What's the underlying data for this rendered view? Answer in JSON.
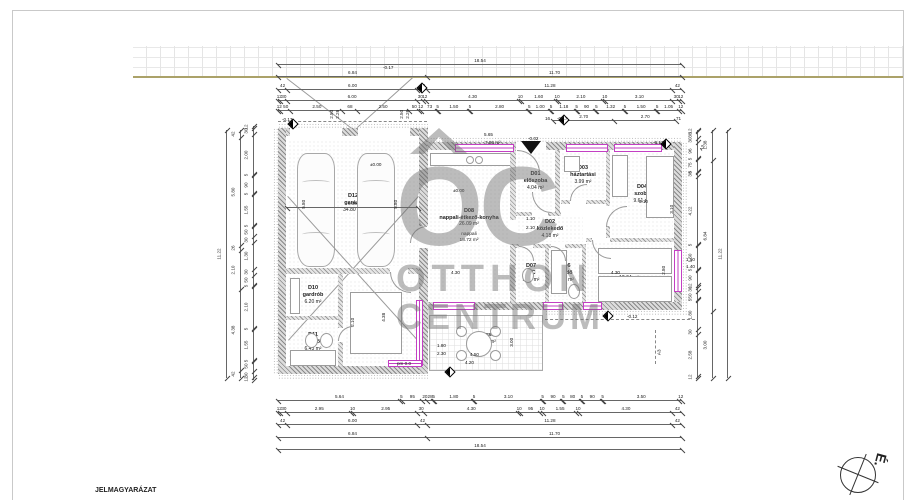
{
  "sheet": {
    "legend_title": "JELMAGYARÁZAT",
    "north_label": "É.",
    "watermark": {
      "oc": "OC",
      "line2": "OTTHON",
      "line3": "CENTRUM"
    },
    "accent_color": "#c33fc3"
  },
  "rooms": [
    {
      "id": "D12",
      "name": "garázs",
      "area": "34.80 m²",
      "x": 288,
      "y": 140,
      "w": 130,
      "h": 126
    },
    {
      "id": "D10",
      "name": "gardrób",
      "area": "6.20 m²",
      "x": 288,
      "y": 276,
      "w": 50,
      "h": 38
    },
    {
      "id": "D11",
      "name": "fürdő",
      "area": "6.43 m²",
      "x": 288,
      "y": 322,
      "w": 50,
      "h": 40
    },
    {
      "id": "D09",
      "name": "szoba",
      "area": "12.92 m²",
      "x": 345,
      "y": 280,
      "w": 74,
      "h": 84
    },
    {
      "id": "D08",
      "name": "nappali-étkező-konyha",
      "area": "26.09 m²",
      "sub1": "nappali",
      "sub2": "18.72 m²",
      "x": 429,
      "y": 152,
      "w": 80,
      "h": 148
    },
    {
      "id": "D01",
      "name": "előszoba",
      "area": "4.04 m²",
      "x": 517,
      "y": 152,
      "w": 37,
      "h": 58
    },
    {
      "id": "D02",
      "name": "közlekedő",
      "area": "4.18 m²",
      "x": 517,
      "y": 216,
      "w": 66,
      "h": 26
    },
    {
      "id": "D03",
      "name": "háztartási",
      "area": "3.99 m²",
      "x": 561,
      "y": 152,
      "w": 44,
      "h": 46
    },
    {
      "id": "D04",
      "name": "szoba",
      "area": "9.61 m²",
      "x": 611,
      "y": 152,
      "w": 62,
      "h": 84
    },
    {
      "id": "D07",
      "name": "WC",
      "area": "1.61 m²",
      "x": 517,
      "y": 246,
      "w": 28,
      "h": 54
    },
    {
      "id": "D06",
      "name": "fürdő",
      "area": "5.39 m²",
      "x": 549,
      "y": 246,
      "w": 33,
      "h": 54
    },
    {
      "id": "D05",
      "name": "szoba",
      "area": "12.04 m²",
      "x": 586,
      "y": 242,
      "w": 86,
      "h": 58
    },
    {
      "id": "",
      "name": "terasz",
      "area": "13.50 m²",
      "x": 429,
      "y": 315,
      "w": 114,
      "h": 56
    }
  ],
  "dims": [
    {
      "t": "h",
      "x1": 278,
      "x2": 682,
      "y": 64,
      "cells": [
        [
          1854,
          "18.54"
        ]
      ]
    },
    {
      "t": "h",
      "x1": 278,
      "x2": 682,
      "y": 76,
      "cells": [
        [
          684,
          "6.84"
        ],
        [
          1170,
          "11.70"
        ]
      ]
    },
    {
      "t": "h",
      "x1": 278,
      "x2": 682,
      "y": 89,
      "cells": [
        [
          42,
          "42"
        ],
        [
          600,
          "6.00"
        ],
        [
          42,
          "42"
        ],
        [
          1128,
          "11.28"
        ],
        [
          42,
          "42"
        ]
      ]
    },
    {
      "t": "h",
      "x1": 278,
      "x2": 682,
      "y": 100,
      "cells": [
        [
          12,
          "12"
        ],
        [
          30,
          "30"
        ],
        [
          600,
          "6.00"
        ],
        [
          30,
          "30"
        ],
        [
          12,
          "12"
        ],
        [
          430,
          "4.30"
        ],
        [
          10,
          "10"
        ],
        [
          160,
          "1.60"
        ],
        [
          10,
          "10"
        ],
        [
          210,
          "2.10"
        ],
        [
          10,
          "10"
        ],
        [
          310,
          "3.10"
        ],
        [
          30,
          "30"
        ],
        [
          12,
          "12"
        ]
      ]
    },
    {
      "t": "h",
      "x1": 278,
      "x2": 682,
      "y": 110,
      "cells": [
        [
          12,
          "12"
        ],
        [
          50,
          "50"
        ],
        [
          250,
          "2.50"
        ],
        [
          68,
          "68"
        ],
        [
          250,
          "2.50"
        ],
        [
          50,
          "50"
        ],
        [
          12,
          "12"
        ],
        [
          73,
          "73"
        ],
        [
          5,
          "5"
        ],
        [
          150,
          "1.50"
        ],
        [
          5,
          "5"
        ],
        [
          280,
          "2.80"
        ],
        [
          5,
          "5"
        ],
        [
          100,
          "1.00"
        ],
        [
          5,
          "5"
        ],
        [
          118,
          "1.18"
        ],
        [
          5,
          "5"
        ],
        [
          90,
          "90"
        ],
        [
          5,
          "5"
        ],
        [
          132,
          "1.32"
        ],
        [
          5,
          "5"
        ],
        [
          150,
          "1.50"
        ],
        [
          5,
          "5"
        ],
        [
          105,
          "1.05"
        ],
        [
          12,
          "12"
        ]
      ]
    },
    {
      "t": "h",
      "x1": 553,
      "x2": 676,
      "y": 120,
      "cells": [
        [
          270,
          "2.70"
        ],
        [
          270,
          "2.70"
        ]
      ]
    },
    {
      "t": "h",
      "x1": 287,
      "x2": 418,
      "y": 207,
      "cells": [
        [
          600,
          "6.00"
        ]
      ]
    },
    {
      "t": "h",
      "x1": 278,
      "x2": 682,
      "y": 400,
      "cells": [
        [
          564,
          "5.64"
        ],
        [
          5,
          "5"
        ],
        [
          95,
          "95"
        ],
        [
          20,
          "20"
        ],
        [
          28,
          "28"
        ],
        [
          5,
          "5"
        ],
        [
          180,
          "1.80"
        ],
        [
          5,
          "5"
        ],
        [
          310,
          "3.10"
        ],
        [
          5,
          "5"
        ],
        [
          90,
          "90"
        ],
        [
          5,
          "5"
        ],
        [
          80,
          "80"
        ],
        [
          5,
          "5"
        ],
        [
          90,
          "90"
        ],
        [
          5,
          "5"
        ],
        [
          350,
          "3.50"
        ],
        [
          12,
          "12"
        ]
      ]
    },
    {
      "t": "h",
      "x1": 278,
      "x2": 682,
      "y": 412,
      "cells": [
        [
          12,
          "12"
        ],
        [
          30,
          "30"
        ],
        [
          295,
          "2.95"
        ],
        [
          10,
          "10"
        ],
        [
          295,
          "2.95"
        ],
        [
          30,
          "30"
        ],
        [
          430,
          "4.30"
        ],
        [
          10,
          "10"
        ],
        [
          95,
          "95"
        ],
        [
          10,
          "10"
        ],
        [
          155,
          "1.55"
        ],
        [
          10,
          "10"
        ],
        [
          430,
          "4.30"
        ],
        [
          42,
          "42"
        ]
      ]
    },
    {
      "t": "h",
      "x1": 278,
      "x2": 682,
      "y": 424,
      "cells": [
        [
          42,
          "42"
        ],
        [
          600,
          "6.00"
        ],
        [
          42,
          "42"
        ],
        [
          1128,
          "11.28"
        ],
        [
          42,
          "42"
        ]
      ]
    },
    {
      "t": "h",
      "x1": 278,
      "x2": 682,
      "y": 437,
      "cells": [
        [
          684,
          "6.84"
        ],
        [
          1170,
          "11.70"
        ]
      ]
    },
    {
      "t": "h",
      "x1": 278,
      "x2": 682,
      "y": 449,
      "cells": [
        [
          1854,
          "18.54"
        ]
      ]
    },
    {
      "t": "v",
      "x": 226,
      "y1": 130,
      "y2": 378,
      "cells": [
        [
          1122,
          "11.22"
        ]
      ]
    },
    {
      "t": "v",
      "x": 240,
      "y1": 130,
      "y2": 378,
      "cells": [
        [
          42,
          "42"
        ],
        [
          580,
          "5.80"
        ],
        [
          26,
          "26"
        ],
        [
          210,
          "2.10"
        ],
        [
          438,
          "4.38"
        ],
        [
          42,
          "42"
        ]
      ]
    },
    {
      "t": "v",
      "x": 253,
      "y1": 126,
      "y2": 380,
      "cells": [
        [
          12,
          "12"
        ],
        [
          30,
          "30"
        ],
        [
          200,
          "2.00"
        ],
        [
          5,
          "5"
        ],
        [
          90,
          "90"
        ],
        [
          5,
          "5"
        ],
        [
          155,
          "1.55"
        ],
        [
          5,
          "5"
        ],
        [
          50,
          "50"
        ],
        [
          30,
          "30"
        ],
        [
          130,
          "1.30"
        ],
        [
          30,
          "30"
        ],
        [
          50,
          "50"
        ],
        [
          5,
          "5"
        ],
        [
          210,
          "2.10"
        ],
        [
          5,
          "5"
        ],
        [
          155,
          "1.55"
        ],
        [
          5,
          "5"
        ],
        [
          50,
          "50"
        ],
        [
          30,
          "30"
        ],
        [
          12,
          "12"
        ]
      ]
    },
    {
      "t": "v",
      "x": 697,
      "y1": 130,
      "y2": 378,
      "cells": [
        [
          12,
          "12"
        ],
        [
          38,
          "38"
        ],
        [
          30,
          "30"
        ],
        [
          96,
          "96"
        ],
        [
          5,
          "5"
        ],
        [
          75,
          "75"
        ],
        [
          5,
          "5"
        ],
        [
          30,
          "30"
        ],
        [
          422,
          "4.22"
        ],
        [
          5,
          "5"
        ],
        [
          150,
          "1.50"
        ],
        [
          5,
          "5"
        ],
        [
          90,
          "90"
        ],
        [
          12,
          "12"
        ],
        [
          30,
          "30"
        ],
        [
          50,
          "50"
        ],
        [
          5,
          "5"
        ],
        [
          180,
          "1.80"
        ],
        [
          30,
          "30"
        ],
        [
          258,
          "2.58"
        ],
        [
          12,
          "12"
        ]
      ]
    },
    {
      "t": "v",
      "x": 712,
      "y1": 130,
      "y2": 378,
      "cells": [
        [
          138,
          "1.38"
        ],
        [
          684,
          "6.84"
        ],
        [
          300,
          "3.00"
        ]
      ]
    },
    {
      "t": "v",
      "x": 727,
      "y1": 130,
      "y2": 378,
      "cells": [
        [
          1122,
          "11.22"
        ]
      ]
    }
  ],
  "labels": [
    [
      383,
      66,
      "-0.17"
    ],
    [
      282,
      118,
      "-0.17"
    ],
    [
      545,
      117,
      "16"
    ],
    [
      557,
      117,
      "-0.17"
    ],
    [
      676,
      117,
      "71"
    ],
    [
      328,
      112,
      "2.50",
      -90
    ],
    [
      334,
      112,
      "2.26",
      -90
    ],
    [
      398,
      112,
      "2.50",
      -90
    ],
    [
      404,
      112,
      "2.26",
      -90
    ],
    [
      484,
      133,
      "5.65"
    ],
    [
      485,
      141,
      "7.80 m²"
    ],
    [
      528,
      137,
      "-0.02"
    ],
    [
      653,
      141,
      "-0.17"
    ],
    [
      700,
      146,
      "A3",
      -60
    ],
    [
      657,
      350,
      "A3",
      -90
    ],
    [
      627,
      315,
      "-0.12"
    ],
    [
      370,
      163,
      "±0.00"
    ],
    [
      453,
      189,
      "±0.00"
    ],
    [
      686,
      258,
      "1.50"
    ],
    [
      686,
      265,
      "1.40"
    ],
    [
      437,
      344,
      "1.80"
    ],
    [
      437,
      352,
      "2.30"
    ],
    [
      470,
      353,
      "4.50"
    ],
    [
      465,
      361,
      "4.20"
    ],
    [
      451,
      271,
      "4.30"
    ],
    [
      611,
      271,
      "4.30"
    ],
    [
      660,
      268,
      "2.80",
      -90
    ],
    [
      639,
      200,
      "3.10"
    ],
    [
      668,
      207,
      "3.10",
      -90
    ],
    [
      526,
      217,
      "1.10"
    ],
    [
      526,
      226,
      "2.10"
    ],
    [
      300,
      202,
      "5.80",
      -90
    ],
    [
      392,
      202,
      "5.80",
      -90
    ],
    [
      349,
      320,
      "2.10",
      -90
    ],
    [
      380,
      315,
      "4.38",
      -90
    ],
    [
      508,
      340,
      "3.00",
      -90
    ],
    [
      397,
      362,
      "pm 0.0"
    ]
  ]
}
